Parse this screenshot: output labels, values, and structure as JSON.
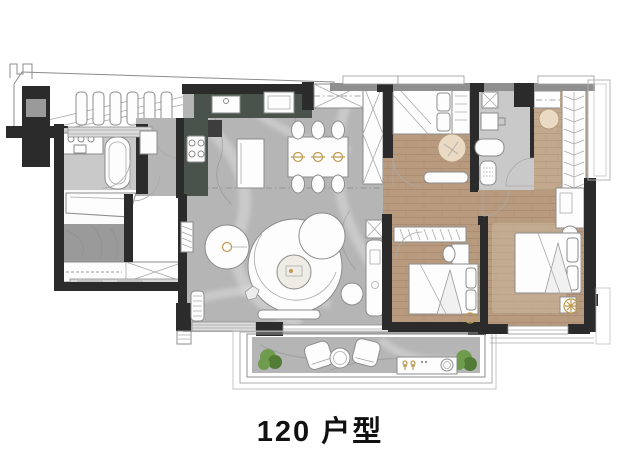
{
  "title": {
    "label": "120 户型"
  },
  "palette": {
    "wall": "#2b2b2b",
    "wall_light": "#8f8f8f",
    "marble": "#b5b5b5",
    "marble_dark": "#9a9a9a",
    "tile": "#c9c9c9",
    "wood": "#b89b7e",
    "counter": "#4a524c",
    "furniture": "#fdfdfd",
    "outline": "#8c8c8c",
    "gold": "#bf9a4f",
    "plant": "#6f9b4c",
    "rug": "#cdbba4",
    "page": "#ffffff"
  },
  "rooms": [
    "shared-corridor",
    "entry-bathroom",
    "entry-foyer",
    "storage-room",
    "kitchen",
    "dining-room",
    "living-room",
    "bedroom-2",
    "bathroom-2",
    "hallway",
    "walk-in-closet",
    "master-bedroom",
    "bedroom-3",
    "balcony"
  ],
  "furniture_icons": [
    "sink-vanity-icon",
    "bathtub-icon",
    "toilet-icon",
    "stove-icon",
    "kitchen-island-icon",
    "dining-table-icon",
    "dining-chair-icon",
    "place-setting-icon",
    "round-table-icon",
    "curved-sofa-icon",
    "coffee-table-icon",
    "pouf-icon",
    "tv-console-icon",
    "bed-icon",
    "nightstand-icon",
    "wardrobe-icon",
    "hanger-rail-icon",
    "desk-icon",
    "ottoman-icon",
    "washing-machine-icon",
    "balcony-chair-icon",
    "plant-icon",
    "rug-icon"
  ]
}
